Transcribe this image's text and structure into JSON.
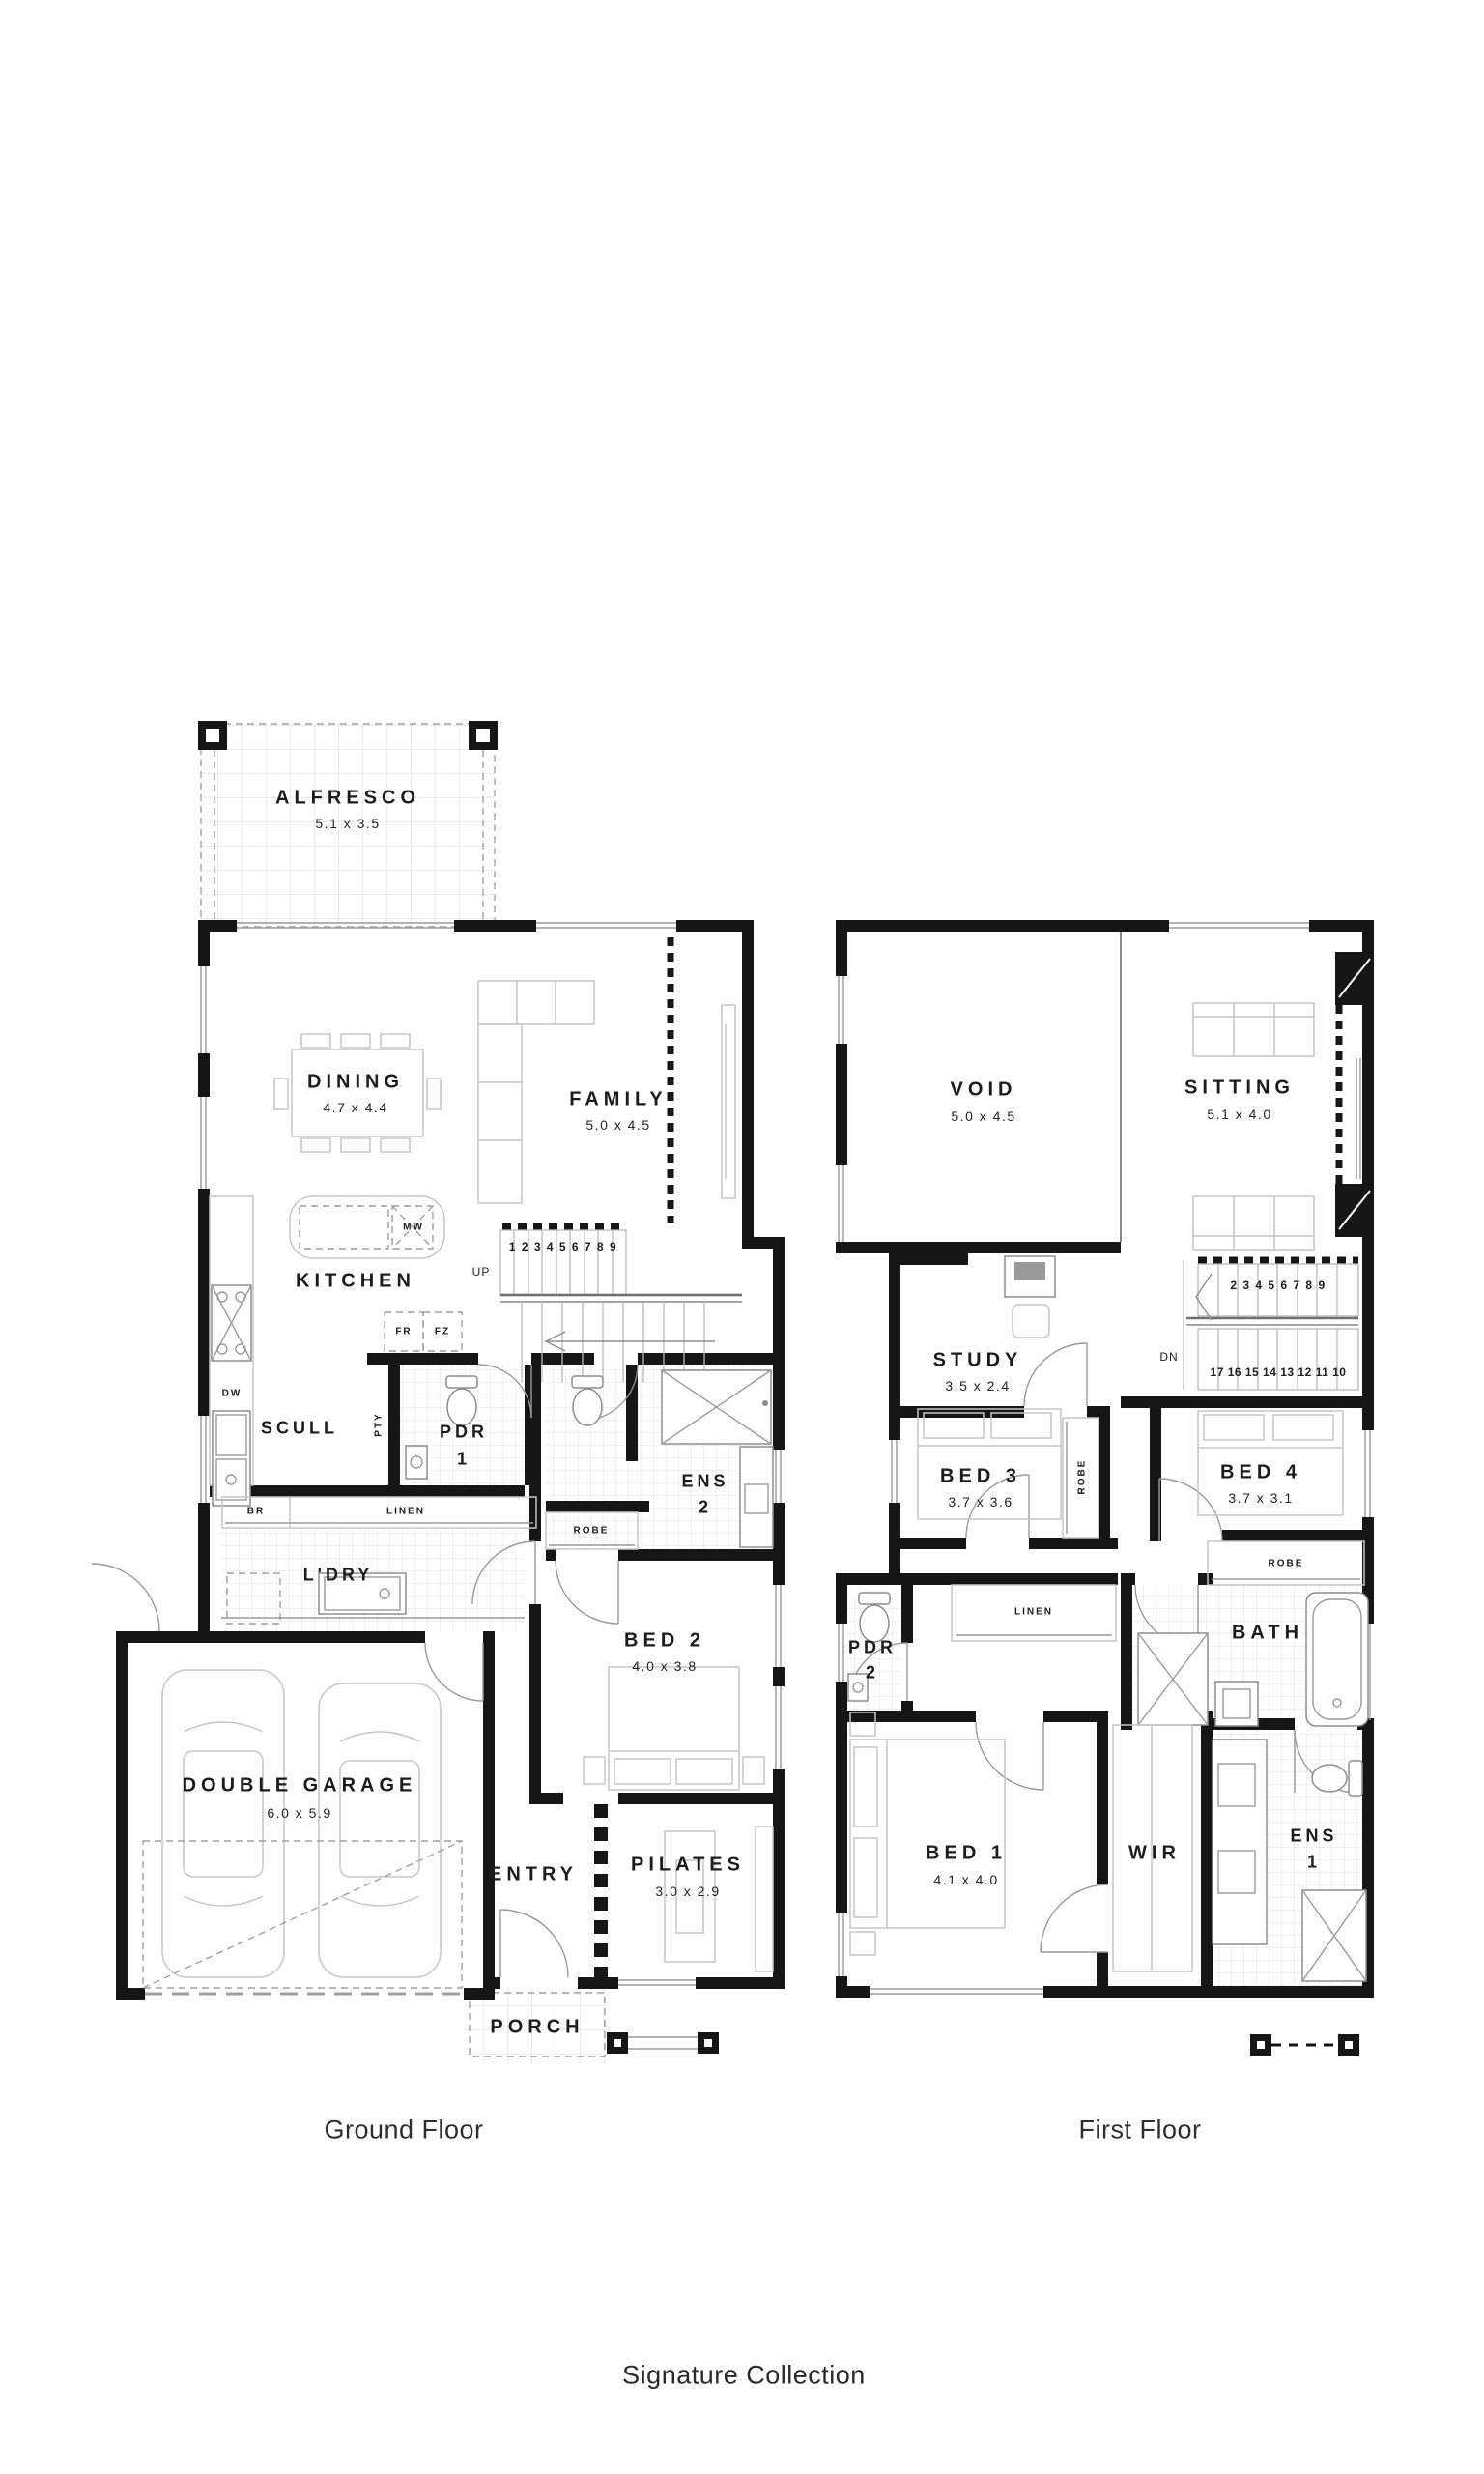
{
  "captions": {
    "ground": "Ground Floor",
    "first": "First Floor"
  },
  "footer": {
    "brand": "Signature Collection"
  },
  "ground": {
    "rooms": {
      "alfresco": {
        "name": "ALFRESCO",
        "dims": "5.1 x 3.5"
      },
      "dining": {
        "name": "DINING",
        "dims": "4.7 x 4.4"
      },
      "family": {
        "name": "FAMILY",
        "dims": "5.0 x 4.5"
      },
      "kitchen": {
        "name": "KITCHEN"
      },
      "scull": {
        "name": "SCULL"
      },
      "pdr1": {
        "name": "PDR",
        "number": "1"
      },
      "ens2": {
        "name": "ENS",
        "number": "2"
      },
      "ldry": {
        "name": "L'DRY"
      },
      "bed2": {
        "name": "BED 2",
        "dims": "4.0 x 3.8"
      },
      "garage": {
        "name": "DOUBLE GARAGE",
        "dims": "6.0 x 5.9"
      },
      "entry": {
        "name": "ENTRY"
      },
      "pilates": {
        "name": "PILATES",
        "dims": "3.0 x 2.9"
      },
      "porch": {
        "name": "PORCH"
      }
    },
    "labels": {
      "mw": "MW",
      "fr": "FR",
      "fz": "FZ",
      "dw": "DW",
      "pty": "PTY",
      "br": "BR",
      "linen": "LINEN",
      "robe": "ROBE"
    },
    "stairs": {
      "direction": "UP",
      "treads": "1 2 3 4 5 6 7 8 9"
    }
  },
  "first": {
    "rooms": {
      "void": {
        "name": "VOID",
        "dims": "5.0 x 4.5"
      },
      "sitting": {
        "name": "SITTING",
        "dims": "5.1 x 4.0"
      },
      "study": {
        "name": "STUDY",
        "dims": "3.5 x 2.4"
      },
      "bed3": {
        "name": "BED 3",
        "dims": "3.7 x 3.6"
      },
      "bed4": {
        "name": "BED 4",
        "dims": "3.7 x 3.1"
      },
      "pdr2": {
        "name": "PDR",
        "number": "2"
      },
      "bath": {
        "name": "BATH"
      },
      "bed1": {
        "name": "BED 1",
        "dims": "4.1 x 4.0"
      },
      "wir": {
        "name": "WIR"
      },
      "ens1": {
        "name": "ENS",
        "number": "1"
      }
    },
    "labels": {
      "linen": "LINEN",
      "robe_bed3": "ROBE",
      "robe_bed4": "ROBE"
    },
    "stairs": {
      "direction": "DN",
      "treads_upper": "2 3 4 5 6 7 8 9",
      "treads_lower": "17 16 15 14 13 12 11 10"
    }
  }
}
